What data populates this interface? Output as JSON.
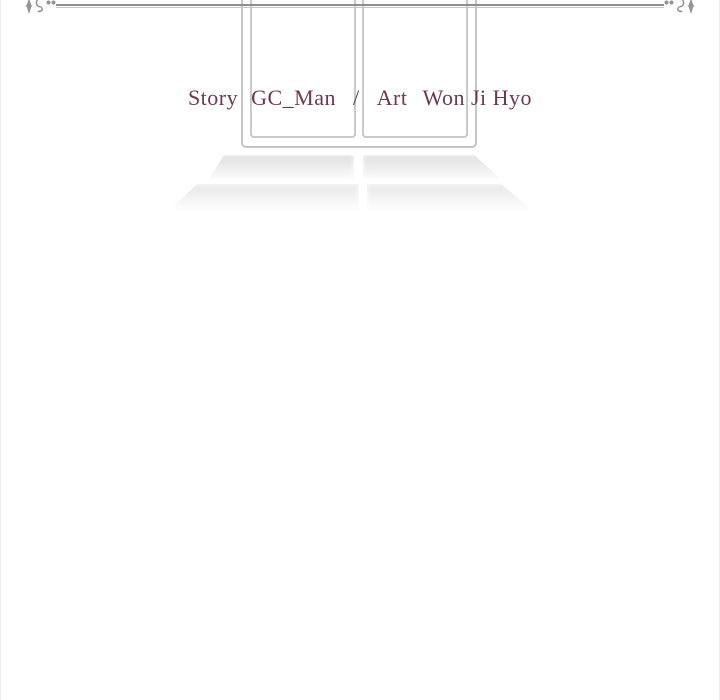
{
  "page": {
    "background_color": "#ffffff",
    "edge_border_color": "#ededed"
  },
  "divider": {
    "line_color": "#8f8f8f",
    "line_shadow_color": "#c9c9c9",
    "ornament_color": "#949494",
    "left_ornament": "flourish-left-icon",
    "right_ornament": "flourish-right-icon"
  },
  "window": {
    "frame_color": "#c5c5c5",
    "pane_border_color": "#c9c9c9",
    "pane_count": 2
  },
  "credits": {
    "story_label": "Story",
    "story_value": "GC_Man",
    "separator": "/",
    "art_label": "Art",
    "art_value": "Won Ji Hyo",
    "text_color": "#6e3a49",
    "full_text": "Story GC_Man / Art Won Ji Hyo"
  },
  "floor_shadow": {
    "rows": 2,
    "patches_per_row": 2,
    "darkest_tone": "#d9d9d9"
  }
}
